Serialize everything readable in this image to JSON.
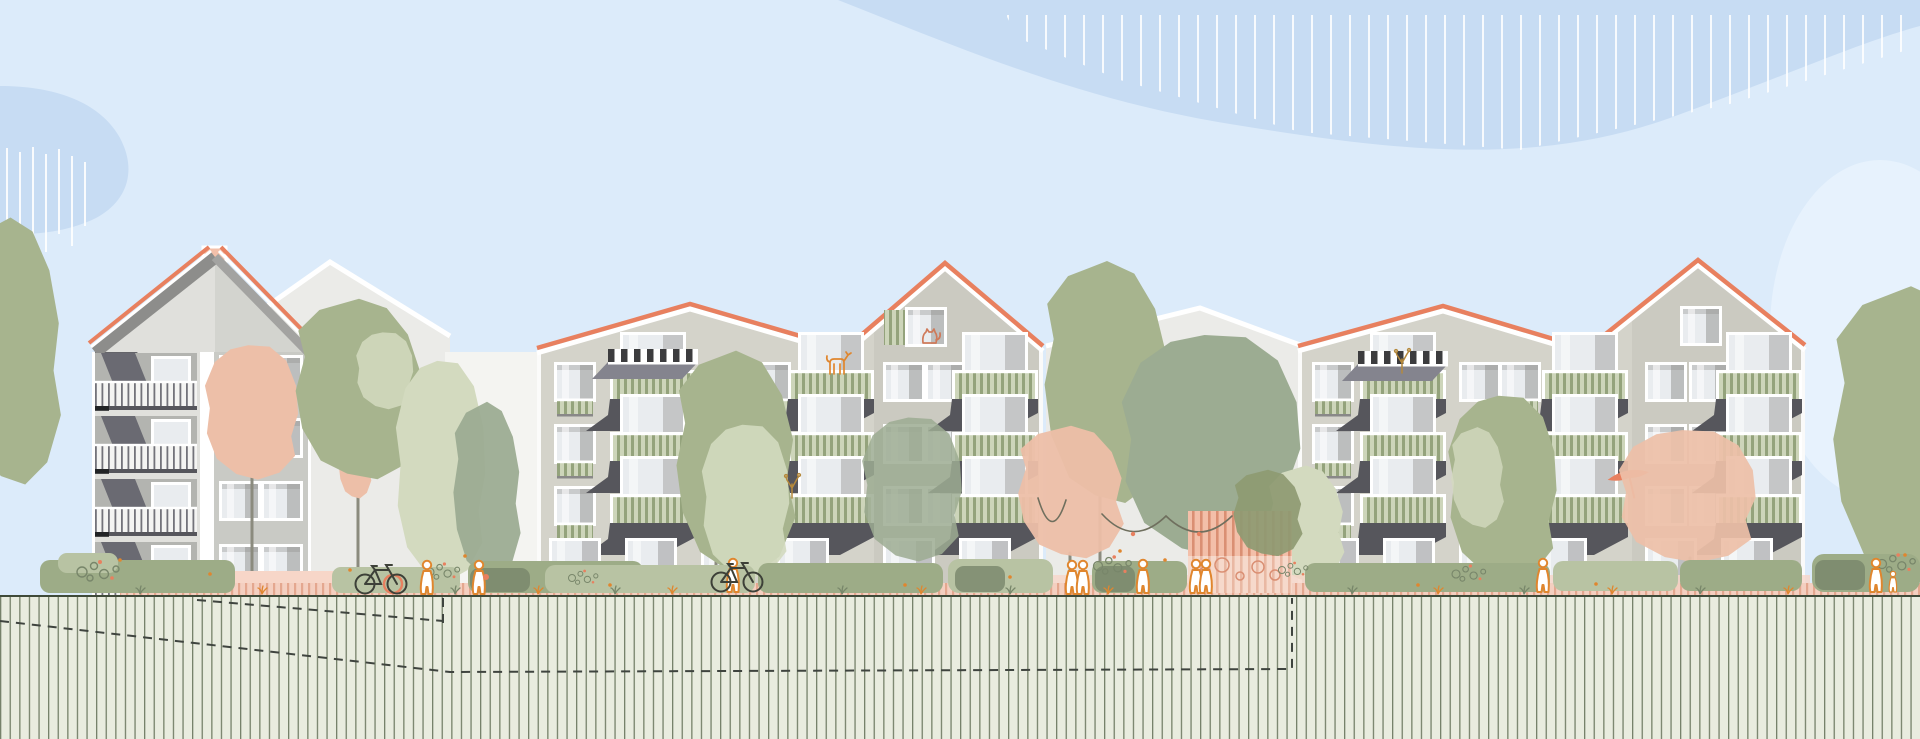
{
  "canvas": {
    "width": 1920,
    "height": 739
  },
  "scene": {
    "type": "architectural-street-elevation-illustration",
    "setting": "Flat-style elevation of a residential quarter: three foreground apartment buildings with coral roof lines, balconies with green slat railings, street landscaping with trees and people, above a hatched ground/soil section with dashed underground outlines",
    "buildings": [
      {
        "id": "left-house",
        "storeys": 4,
        "roof": "steep gable with chimney",
        "features": [
          "full-width balconies with white slat railings",
          "two window columns on right wing"
        ]
      },
      {
        "id": "mid-complex",
        "storeys": 4,
        "roof": "shallow gable + steep gable, coral ridge line",
        "features": [
          "green slat balconies",
          "black-and-white striped awning",
          "gable window with green shutter and cat",
          "dog on top balcony"
        ]
      },
      {
        "id": "right-complex",
        "storeys": 4,
        "roof": "shallow gable + steep gable, coral ridge line",
        "features": [
          "green slat balconies",
          "black-and-white striped awning",
          "balcony plant",
          "coral parasol with person on balcony",
          "plain gable window"
        ]
      }
    ],
    "background_buildings": 2,
    "sky": [
      "large blue cloud band top-right with white vertical hatching",
      "blue cloud blob at left with white vertical hatching",
      "light cloud lower right"
    ],
    "trees": {
      "sage_green": 9,
      "salmon_pink": 4,
      "pale_green": 4,
      "olive_patch": 1
    },
    "street_elements": [
      "hedges and shrubs",
      "pink hatched footpath",
      "salmon plinth strips",
      "pink pergola with garland and flower bed",
      "swing hanging from salmon tree",
      "flower clusters",
      "grass tufts"
    ],
    "figures": [
      "walker",
      "walker with bag",
      "cyclist pushing bike",
      "couple",
      "pedestrian",
      "pair of pedestrians",
      "pedestrian right",
      "adult with child",
      "person under balcony parasol"
    ],
    "objects": [
      "parked bicycle with coral stand ring",
      "bicycle with rider",
      "dashed underground/basement outline",
      "vertical hatched ground section"
    ]
  },
  "colors": {
    "sky": "#dcebfa",
    "cloud": "#c7dcf3",
    "cloud_light": "#e7f2fd",
    "bg_building": "#ebebe8",
    "bg_white": "#f4f4f1",
    "facade": "#d4d3ca",
    "facade_alt": "#cbcac1",
    "facade_left_a": "#e0e0dc",
    "facade_left_b": "#c9cac5",
    "roof_coral": "#e8805f",
    "roof_gray": "#8d8d8b",
    "roof_gray_light": "#a3a3a1",
    "chimney": "#f3c0aa",
    "glass": "#e9ecef",
    "reveal": "#8f8f8d",
    "rail_green_bg": "#cdd5ba",
    "rail_green_ln": "#94a37c",
    "rail_white_bg": "#f4f4f2",
    "rail_white_ln": "#73737a",
    "slab": "#56565c",
    "canopy": "#84848e",
    "canopy_dark": "#6a6a72",
    "awning_dark": "#3c3c3e",
    "lh_rear": "#b3b4b0",
    "hedge": "#9dac87",
    "hedge_light": "#b8c3a3",
    "hedge_dark": "#78866a",
    "path_pink": "#f4cfc0",
    "path_hatch": "#df997e",
    "plinth": "#f7d6c8",
    "ground_bg": "#e9ecdf",
    "ground_line": "#3f4a39",
    "ground_hatch": "#76816a",
    "tree_sage": "#a7b48e",
    "tree_sage_light": "#c6cfb1",
    "tree_sage_gray": "#9cac92",
    "tree_pale": "#d3dabf",
    "tree_olive": "#8e9a72",
    "tree_salmon": "#edbfa8",
    "figure_orange": "#e0862e",
    "cat_red": "#cf7a5a",
    "plant_ochre": "#b5893c",
    "pergola_pink": "#f3bfa9",
    "pergola_line": "#da8f73",
    "pergola_lower": "#f6d9cb",
    "trunk": "#8b8b7e",
    "dash": "#3f443f",
    "bike_dark": "#3d4038",
    "garland": "#6f6f5e"
  }
}
